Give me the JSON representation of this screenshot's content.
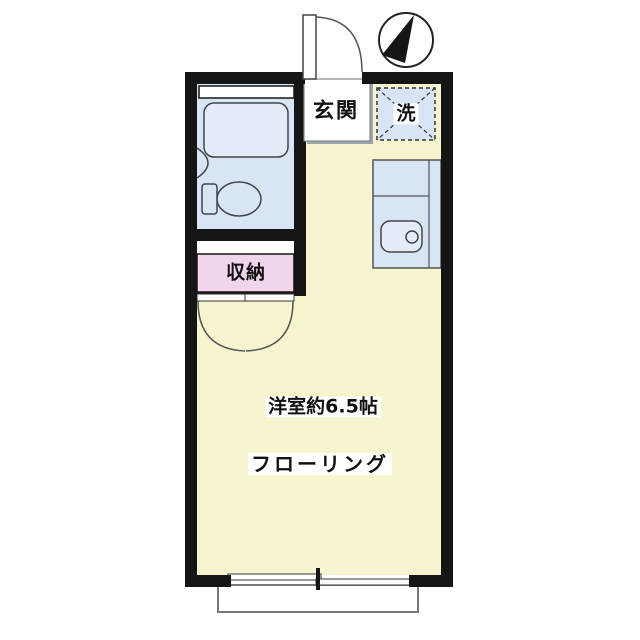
{
  "plan": {
    "type": "apartment-floor-plan",
    "compass": {
      "direction": "N",
      "needle_points": "up"
    },
    "rooms": {
      "entrance": {
        "label": "玄関"
      },
      "laundry_space": {
        "label": "洗"
      },
      "storage": {
        "label": "収納"
      },
      "main_room": {
        "label": "洋室約6.5帖",
        "floor_note": "フローリング"
      }
    },
    "fixtures": [
      "bathtub",
      "washbasin",
      "toilet",
      "kitchen-counter",
      "kitchen-sink",
      "entrance-door",
      "closet-double-doors",
      "sliding-window",
      "balcony"
    ],
    "colors": {
      "wall": "#151515",
      "room_fill": "#f7f5cf",
      "wet_fill": "#d8e5f4",
      "fixture_fill": "#e3edf9",
      "storage_fill": "#f2d5ea",
      "white": "#ffffff",
      "outline": "#444444",
      "balcony_line": "#777777",
      "shadow": "#9aa4ad"
    }
  }
}
